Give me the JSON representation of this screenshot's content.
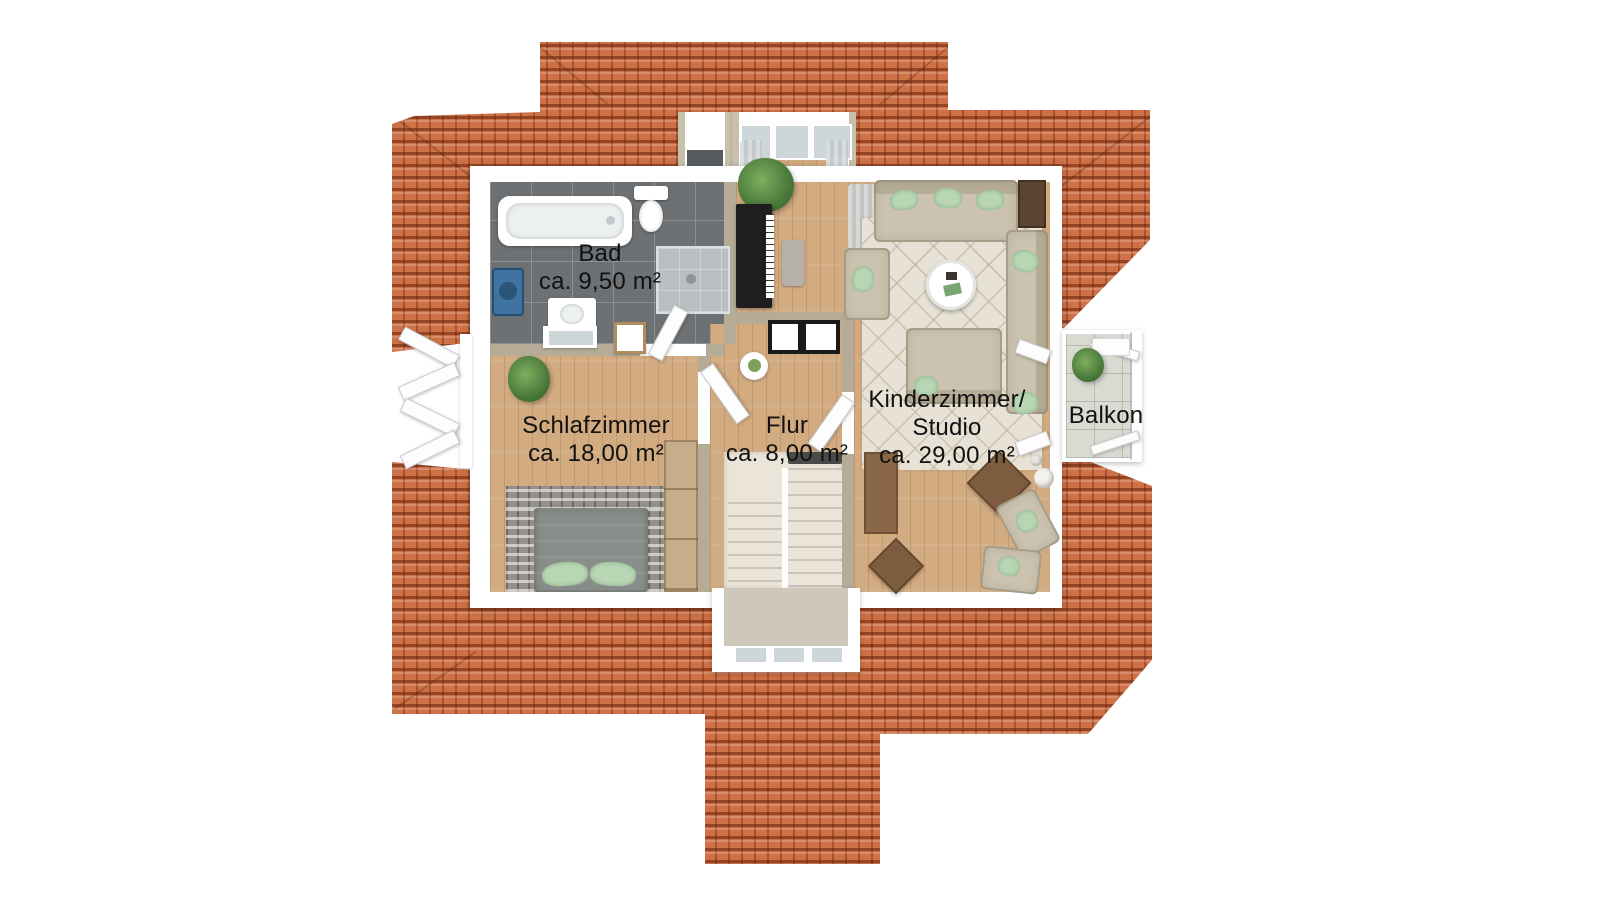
{
  "labels": {
    "bad": {
      "name": "Bad",
      "area": "ca. 9,50 m²"
    },
    "schlafzimmer": {
      "name": "Schlafzimmer",
      "area": "ca. 18,00 m²"
    },
    "flur": {
      "name": "Flur",
      "area": "ca. 8,00 m²"
    },
    "kinderzimmer": {
      "line1": "Kinderzimmer/",
      "line2": "Studio",
      "area": "ca. 29,00 m²"
    },
    "balkon": {
      "name": "Balkon"
    }
  },
  "colors": {
    "roof": "#ce7146",
    "roof_dark": "#7e2f12",
    "wood": "#d2ab80",
    "bath_tile": "#6d7174",
    "wall": "#b5ab97",
    "sofa": "#cbc3af",
    "pillow": "#b8d6b3",
    "bed": "#8a8e8b",
    "stone": "#94908a",
    "rug": "#e7e2d5",
    "stair": "#ebe4d9",
    "balcony_tile": "#d8dbd2",
    "plant": "#4f7f3e",
    "plant_dark": "#35622a",
    "piano": "#1e1e20",
    "wood_furniture": "#8a6847",
    "wood_dark": "#5c4430",
    "glass": "#cdd6d9",
    "washer": "#3f74a0",
    "label_text": "#111111"
  }
}
